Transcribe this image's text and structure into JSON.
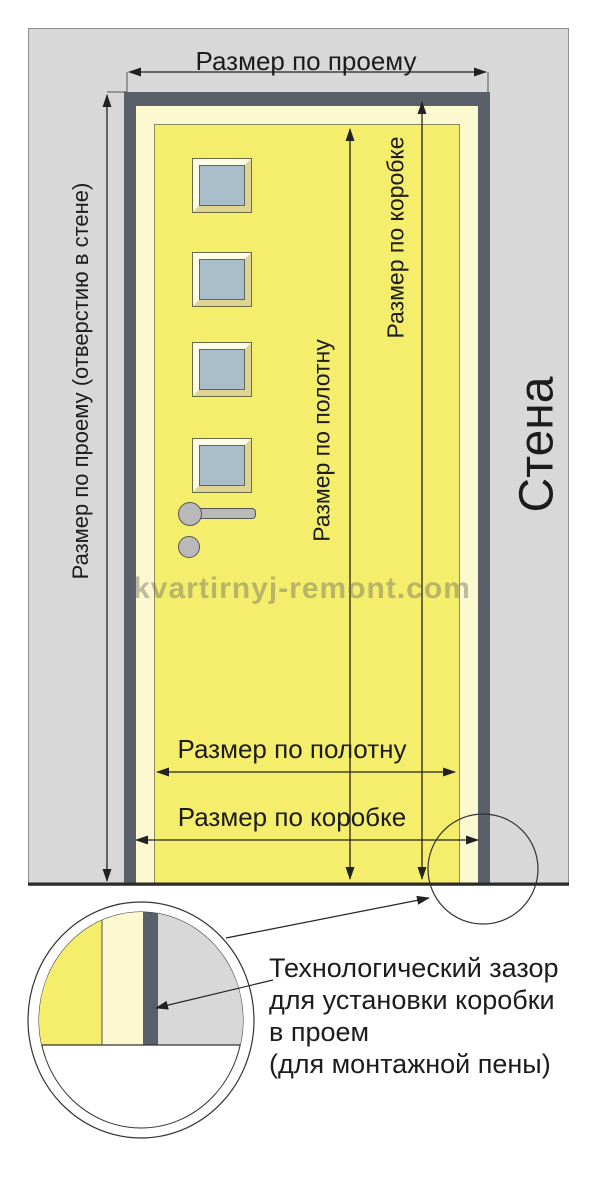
{
  "labels": {
    "opening_width": "Размер по проему",
    "opening_height": "Размер по проему (отверстию в стене)",
    "frame_height": "Размер по коробке",
    "leaf_height": "Размер по полотну",
    "leaf_width": "Размер по полотну",
    "frame_width": "Размер по коробке",
    "wall": "Стена"
  },
  "watermark": "kvartirnyj-remont.com",
  "callout": {
    "lines": [
      "Технологический зазор",
      "для установки коробки",
      "в проем",
      "(для монтажной пены)"
    ]
  },
  "palette": {
    "wall": "#d8d8d8",
    "frame": "#59606a",
    "frame_inner": "#fcf9d0",
    "leaf": "#f5ee6d",
    "glass": "#a9bdca",
    "line": "#222222"
  }
}
